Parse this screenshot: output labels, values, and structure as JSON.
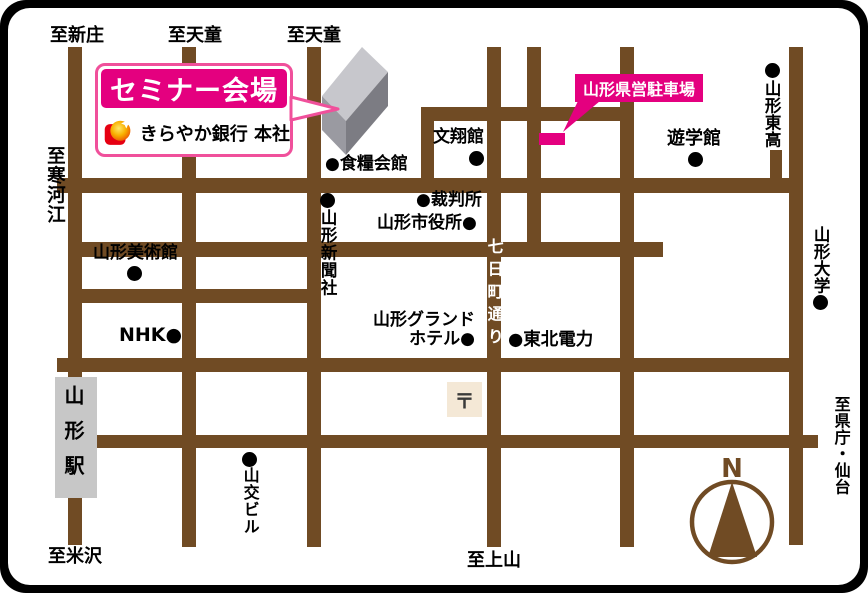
{
  "venue": {
    "banner": "セミナー会場",
    "bank": "きらやか銀行 本社",
    "parking_label": "山形県営駐車場"
  },
  "directions": {
    "to_shinjo": "至新庄",
    "to_tendo_1": "至天童",
    "to_tendo_2": "至天童",
    "to_sagae": "至寒河江",
    "to_yonezawa": "至米沢",
    "to_kaminoyama": "至上山",
    "to_kencho_sendai": "至県庁・仙台"
  },
  "streets": {
    "nanokamachi_dori": "七日町通り"
  },
  "landmarks": {
    "shokuryo_kaikan": "●食糧会館",
    "bunshokan": "文翔館",
    "saibansho": "●裁判所",
    "shiyakusho": "山形市役所●",
    "yamagata_shinbunsha": "山形新聞社",
    "bijutsukan": "山形美術館",
    "nhk": "NHK●",
    "grand_hotel": "山形グランド\nホテル●",
    "tohoku_denryoku": "●東北電力",
    "yugakukan": "遊学館",
    "yamagata_higashi_high": "山形東高",
    "yamagata_daigaku": "山形大学",
    "sanko_building": "山交ビル",
    "yamagata_station": "山形駅",
    "post_office_mark": "〒"
  },
  "compass": {
    "north": "N"
  },
  "colors": {
    "road_brown": "#704b24",
    "accent_pink": "#e4007f",
    "bubble_border_pink": "#f0509b",
    "station_gray": "#c7c7c7",
    "building_top": "#c7c7cc",
    "building_front": "#9a9aa1",
    "building_side": "#7c7c83",
    "post_office_bg": "#f4e8d6",
    "logo_red": "#e60012",
    "logo_orange": "#f8b000"
  }
}
